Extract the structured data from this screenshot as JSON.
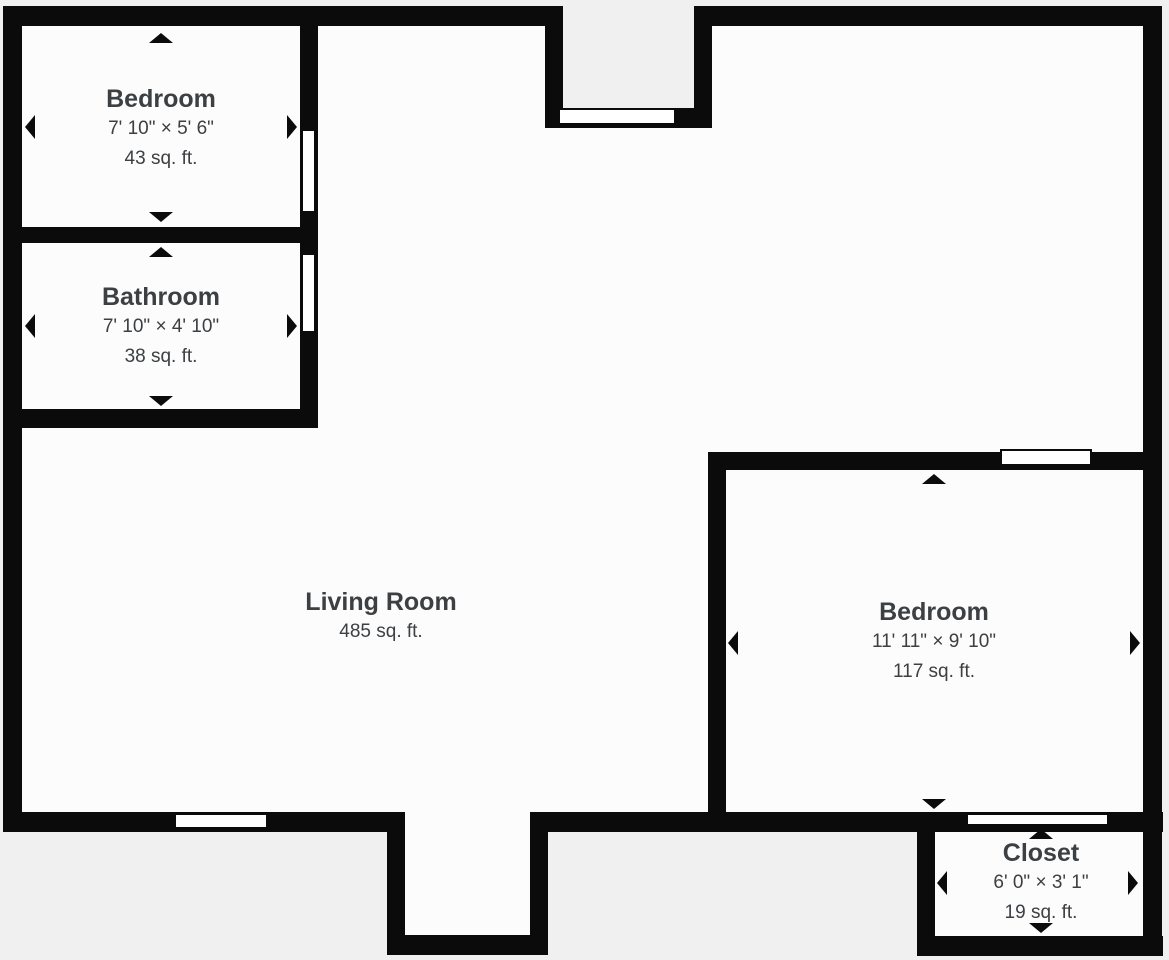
{
  "colors": {
    "bg": "#f0f0f0",
    "floor": "#fcfcfc",
    "wall": "#0b0b0b",
    "text": "#3c4043",
    "window": "#ffffff"
  },
  "rooms": [
    {
      "name": "Bedroom",
      "dimensions": "7' 10\" × 5' 6\"",
      "area": "43 sq. ft."
    },
    {
      "name": "Bathroom",
      "dimensions": "7' 10\" × 4' 10\"",
      "area": "38 sq. ft."
    },
    {
      "name": "Living Room",
      "area": "485 sq. ft."
    },
    {
      "name": "Bedroom",
      "dimensions": "11' 11\" × 9' 10\"",
      "area": "117 sq. ft."
    },
    {
      "name": "Closet",
      "dimensions": "6' 0\" × 3' 1\"",
      "area": "19 sq. ft."
    }
  ],
  "icons": {
    "dimension_arrows": [
      "up",
      "down",
      "left",
      "right"
    ]
  }
}
